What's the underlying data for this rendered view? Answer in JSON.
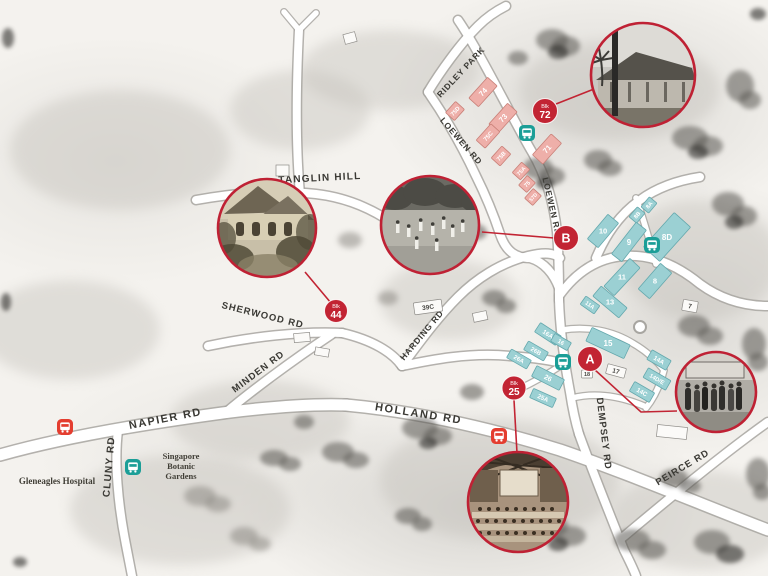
{
  "colors": {
    "marker_red": "#c22433",
    "photo_ring_red": "#bf2134",
    "connector_red": "#c22433",
    "bus_teal": "#1b9e97",
    "bus_red": "#e43d2f",
    "building_teal": "#9bd0d3",
    "building_pink": "#eeafa9",
    "road_label": "#3a3934"
  },
  "icons": {
    "bus": "bus-icon"
  },
  "roads": {
    "ridley_park": "RIDLEY PARK",
    "loewen_left": "LOEWEN RD",
    "loewen_right": "LOEWEN RD",
    "tanglin_hill": "TANGLIN HILL",
    "sherwood": "SHERWOOD RD",
    "minden": "MINDEN RD",
    "harding": "HARDING RD",
    "napier": "NAPIER RD",
    "cluny": "CLUNY RD",
    "holland": "HOLLAND RD",
    "dempsey": "DEMPSEY RD",
    "peirce": "PEIRCE RD"
  },
  "places": {
    "gleneagles": "Gleneagles Hospital",
    "botanic_line1": "Singapore",
    "botanic_line2": "Botanic",
    "botanic_line3": "Gardens"
  },
  "markers": {
    "blk72": {
      "top": "Blk",
      "num": "72"
    },
    "blk44": {
      "top": "Blk",
      "num": "44"
    },
    "blk25": {
      "top": "Blk",
      "num": "25"
    },
    "a": "A",
    "b": "B"
  },
  "buildings": {
    "pink": [
      "74",
      "75D",
      "73",
      "75C",
      "75B",
      "71",
      "75A",
      "75",
      "57D"
    ],
    "teal": [
      "8A",
      "8B",
      "8D",
      "9",
      "10",
      "11",
      "8",
      "13",
      "11A",
      "16A",
      "16",
      "26B",
      "26A",
      "26",
      "25A",
      "15",
      "14A",
      "14D/E",
      "14C"
    ],
    "white": [
      "39C",
      "17",
      "18",
      "7"
    ]
  },
  "photos": {
    "top_right": "colonial-bungalow-photo",
    "left": "gabled-house-photo",
    "center": "cricket-match-photo",
    "right": "crowd-photo",
    "bottom": "dining-hall-photo"
  }
}
